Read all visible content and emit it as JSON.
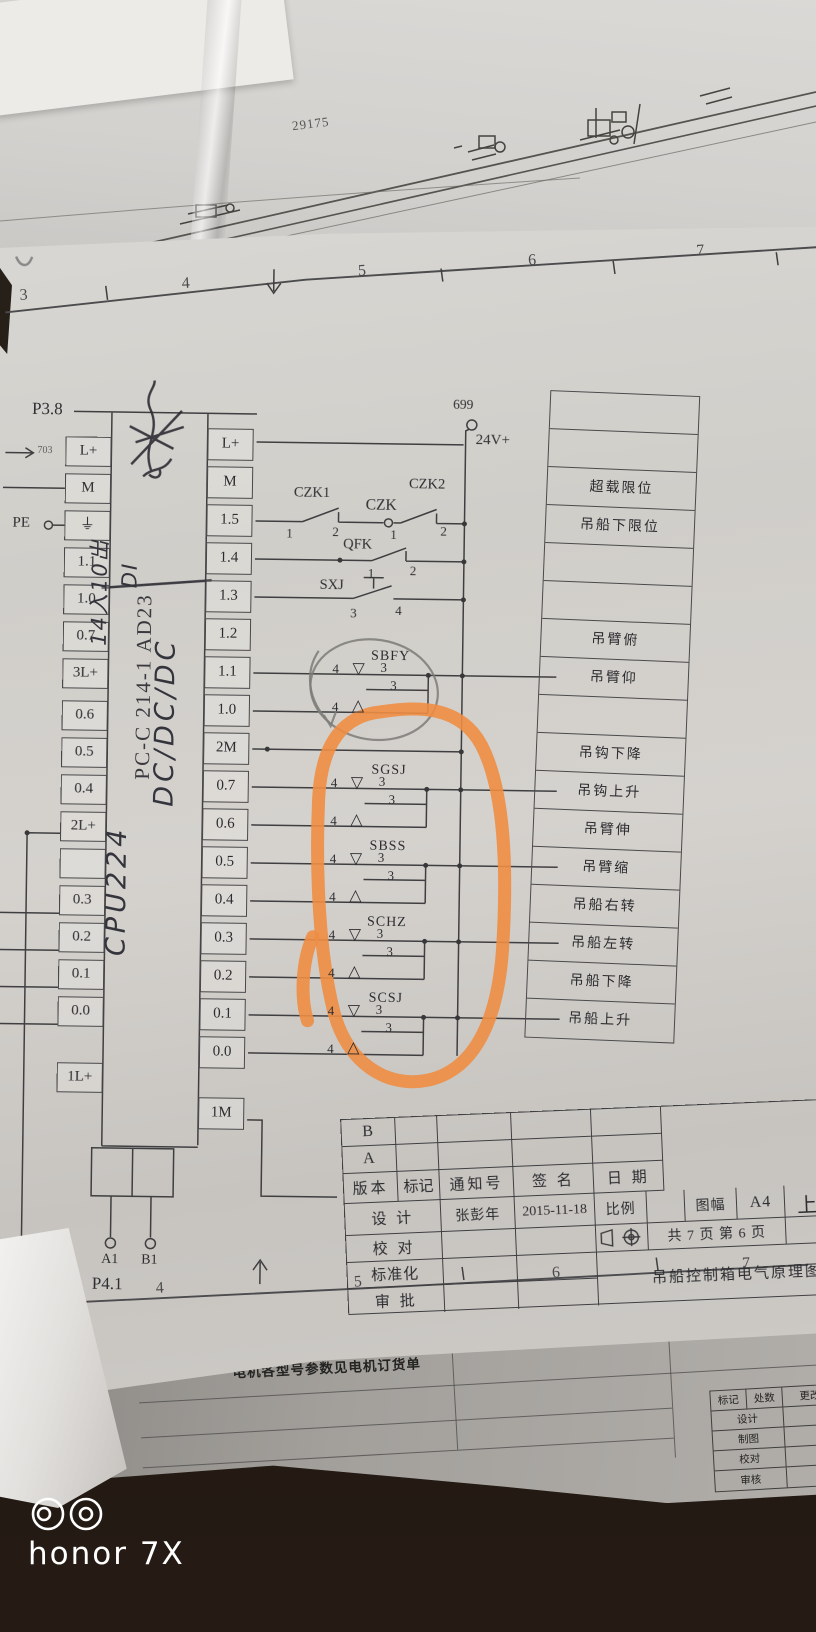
{
  "device": {
    "watermark": "honor 7X"
  },
  "top_sheet": {
    "dim_label": "29175"
  },
  "schematic": {
    "sheet_refs": {
      "prev": "P3.8",
      "next": "P4.1",
      "incoming_net": "703",
      "wire_number": "699",
      "supply": "24V+",
      "pe": "PE"
    },
    "grid_top": [
      "3",
      "4",
      "5",
      "6",
      "7"
    ],
    "grid_bottom": [
      "4",
      "5",
      "6",
      "7"
    ],
    "plc": {
      "hw_line1": "CPU224",
      "hw_line2": "DC/DC/DC",
      "io_line1": "14入10出",
      "io_line2": "DI",
      "model": "PC-C 214-1 AD23",
      "left_terminals": [
        "L+",
        "M",
        "⏚",
        "1.1",
        "1.0",
        "0.7",
        "3L+",
        "0.6",
        "0.5",
        "0.4",
        "2L+",
        "",
        "0.3",
        "0.2",
        "0.1",
        "0.0",
        "1L+"
      ],
      "right_terminals": [
        "L+",
        "M",
        "1.5",
        "1.4",
        "1.3",
        "1.2",
        "1.1",
        "1.0",
        "2M",
        "0.7",
        "0.6",
        "0.5",
        "0.4",
        "0.3",
        "0.2",
        "0.1",
        "0.0",
        "1M"
      ],
      "out_a": "A1",
      "out_b": "B1"
    },
    "switches": {
      "czk1": {
        "name": "CZK1",
        "c1": "1",
        "c2": "2"
      },
      "czk": {
        "name": "CZK"
      },
      "czk2": {
        "name": "CZK2",
        "c1": "1",
        "c2": "2"
      },
      "qfk": {
        "name": "QFK",
        "c1": "1",
        "c2": "2"
      },
      "sxj": {
        "name": "SXJ",
        "c1": "3",
        "c2": "4"
      }
    },
    "joysticks": [
      {
        "name": "SBFY",
        "pin_left_upper": "4",
        "pin_upper": "3",
        "pin_mid": "3",
        "pin_left_lower": "4",
        "icon_down": "▽",
        "icon_up": "△"
      },
      {
        "name": "SGSJ",
        "pin_left_upper": "4",
        "pin_upper": "3",
        "pin_mid": "3",
        "pin_left_lower": "4",
        "icon_down": "▽",
        "icon_up": "△"
      },
      {
        "name": "SBSS",
        "pin_left_upper": "4",
        "pin_upper": "3",
        "pin_mid": "3",
        "pin_left_lower": "4",
        "icon_down": "▽",
        "icon_up": "△"
      },
      {
        "name": "SCHZ",
        "pin_left_upper": "4",
        "pin_upper": "3",
        "pin_mid": "3",
        "pin_left_lower": "4",
        "icon_down": "▽",
        "icon_up": "△"
      },
      {
        "name": "SCSJ",
        "pin_left_upper": "4",
        "pin_upper": "3",
        "pin_mid": "3",
        "pin_left_lower": "4",
        "icon_down": "▽",
        "icon_up": "△"
      }
    ],
    "io_table": [
      "",
      "",
      "超载限位",
      "吊船下限位",
      "",
      "",
      "吊臂俯",
      "吊臂仰",
      "",
      "吊钩下降",
      "吊钩上升",
      "吊臂伸",
      "吊臂缩",
      "吊船右转",
      "吊船左转",
      "吊船下降",
      "吊船上升"
    ],
    "title_block": {
      "rev_b": "B",
      "rev_a": "A",
      "h_version": "版本",
      "h_mark": "标记",
      "h_notice": "通知号",
      "h_sign": "签  名",
      "h_date": "日  期",
      "design": "设  计",
      "designer": "张彭年",
      "date": "2015-11-18",
      "scale": "比例",
      "size": "图幅",
      "size_val": "A4",
      "check": "校  对",
      "pages": "共 7 页 第 6 页",
      "std": "标准化",
      "approve": "审  批",
      "title": "吊船控制箱电气原理图",
      "edge_partial": "上"
    }
  },
  "bottom_sheet": {
    "note": "电机各型号参数见电机订货单",
    "h_mark": "标记",
    "h_count": "处数",
    "h_file": "更改文件号",
    "r_design": "设计",
    "r_draw": "制图",
    "r_check": "校对",
    "r_audit": "审核"
  }
}
